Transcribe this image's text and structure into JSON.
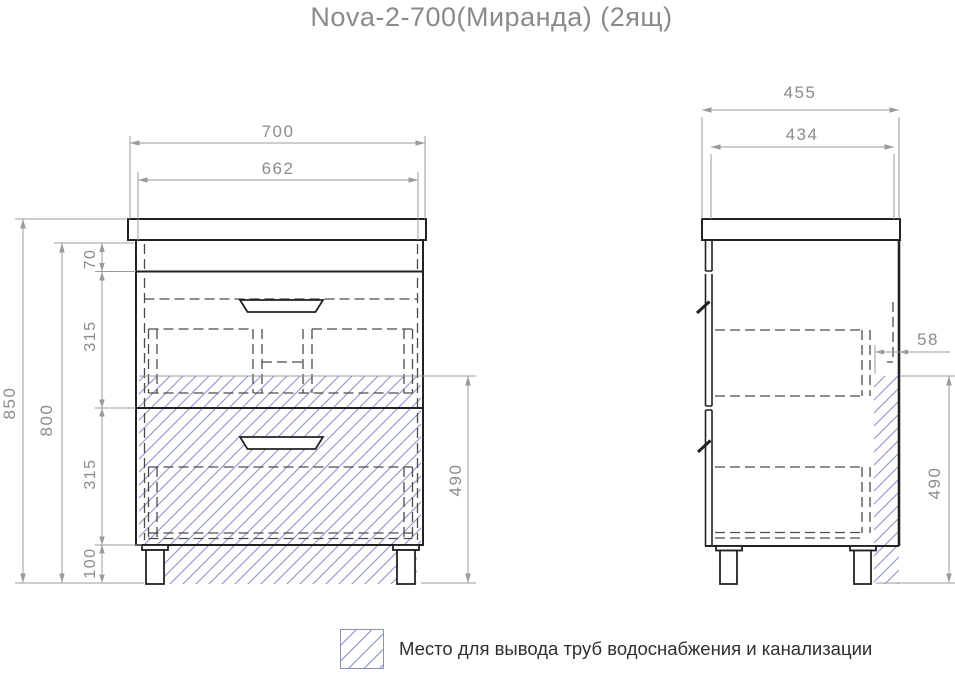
{
  "title": "Nova-2-700(Миранда) (2ящ)",
  "colors": {
    "drawing_line": "#222222",
    "dimension_line": "#9b9b9b",
    "dimension_text": "#8c8c8c",
    "hatch": "#8a90c8",
    "title_text": "#8a8a8a",
    "legend_text": "#2f2f2f"
  },
  "front_view": {
    "dims": {
      "overall_width": "700",
      "inner_width": "662",
      "overall_height": "850",
      "body_height": "800",
      "top_rail": "70",
      "drawer1_height": "315",
      "drawer2_height": "315",
      "leg_height": "100",
      "pipe_zone_height": "490"
    }
  },
  "side_view": {
    "dims": {
      "overall_depth": "455",
      "body_depth": "434",
      "pipe_zone_offset": "58",
      "pipe_zone_height": "490"
    }
  },
  "legend": {
    "label": "Место для вывода труб водоснабжения и канализации"
  }
}
